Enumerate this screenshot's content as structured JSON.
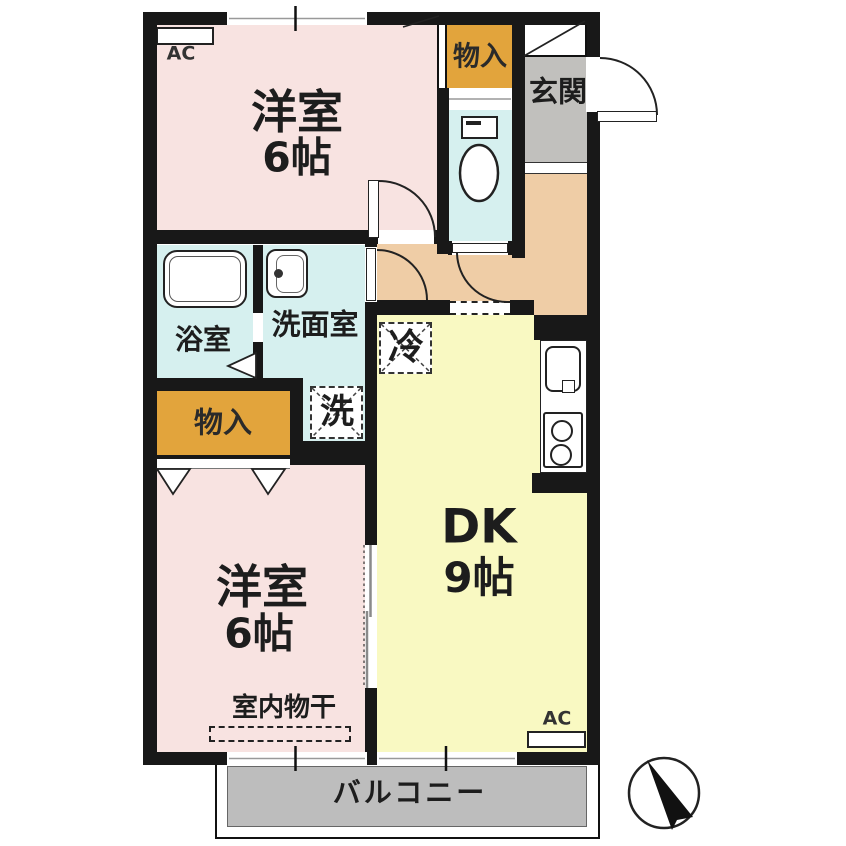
{
  "plan": {
    "rooms": {
      "western_top": {
        "name": "洋室",
        "size": "6帖"
      },
      "western_bottom": {
        "name": "洋室",
        "size": "6帖"
      },
      "dining_kitchen": {
        "name": "DK",
        "size": "9帖"
      },
      "bath": {
        "name": "浴室"
      },
      "washroom": {
        "name": "洗面室"
      },
      "entrance": {
        "name": "玄関"
      },
      "balcony": {
        "name": "バルコニー"
      }
    },
    "storage": {
      "top_label": "物入",
      "middle_label": "物入"
    },
    "equipment": {
      "fridge": "冷",
      "washer": "洗",
      "ac_top": "AC",
      "ac_bottom": "AC",
      "indoor_drying": "室内物干"
    },
    "colors": {
      "wall": "#181818",
      "western_room": "#f8e3e1",
      "dining_kitchen": "#f9f9c2",
      "hallway": "#efcda6",
      "wet_area": "#d6f0ef",
      "storage": "#e2a43c",
      "entrance_floor": "#c1c0bd",
      "balcony": "#bdbdbd"
    }
  }
}
